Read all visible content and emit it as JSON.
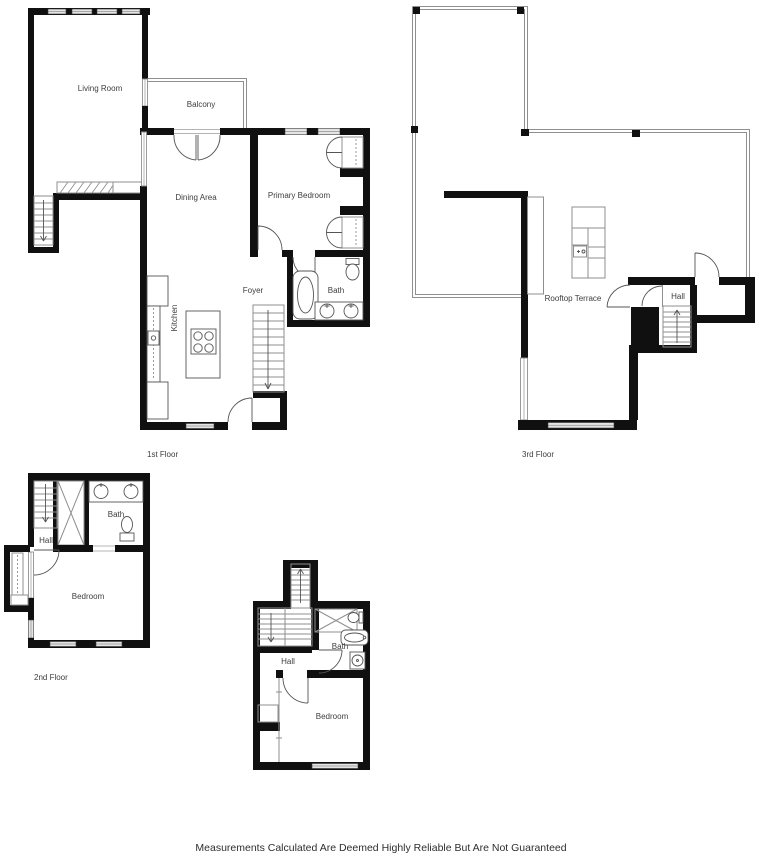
{
  "disclaimer": "Measurements Calculated Are Deemed Highly Reliable But Are Not Guaranteed",
  "floors": {
    "first": {
      "label": "1st Floor",
      "rooms": {
        "living_room": "Living Room",
        "balcony": "Balcony",
        "dining_area": "Dining Area",
        "primary_bedroom": "Primary Bedroom",
        "foyer": "Foyer",
        "bath": "Bath",
        "kitchen": "Kitchen"
      }
    },
    "second": {
      "label": "2nd Floor",
      "rooms": {
        "hall": "Hall",
        "bath": "Bath",
        "bedroom": "Bedroom"
      }
    },
    "third": {
      "label": "3rd Floor",
      "rooms": {
        "rooftop_terrace": "Rooftop Terrace",
        "hall": "Hall"
      }
    },
    "lower": {
      "rooms": {
        "hall": "Hall",
        "bath": "Bath",
        "bedroom": "Bedroom"
      }
    }
  }
}
